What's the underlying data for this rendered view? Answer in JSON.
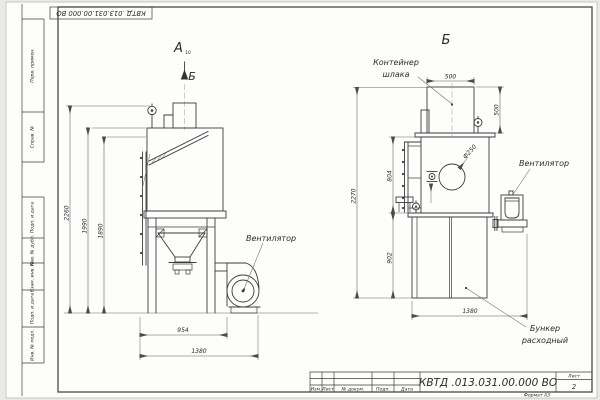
{
  "sheet": {
    "top_ref_code": "КВТД .013.031.00.000  ВО",
    "stamp_column": [
      "Перв. примен.",
      "Справ. №",
      "Подп. и дата",
      "Инв. № дубл.",
      "Взам. инв. №",
      "Подп. и дата",
      "Инв. № подл."
    ],
    "format_note": "Формат А3"
  },
  "title_block": {
    "code": "КВТД .013.031.00.000  ВО",
    "columns": [
      "Изм.",
      "Лист",
      "№ докум.",
      "Подп.",
      "Дата"
    ],
    "sheet_label": "Лист",
    "sheet_number": "2"
  },
  "views": {
    "a": {
      "label": "А",
      "label_sub": "10",
      "section_mark": "Б",
      "fan_label": "Вентилятор",
      "dims": {
        "h_total": "2260",
        "h_body": "1990",
        "h_inner": "1890",
        "w_frame": "954",
        "w_total": "1380"
      }
    },
    "b": {
      "label": "Б",
      "container_label_1": "Контейнер",
      "container_label_2": "шлака",
      "fan_label": "Вентилятор",
      "hopper_label_1": "Бункер",
      "hopper_label_2": "расходный",
      "dims": {
        "w_container": "500",
        "h_container": "500",
        "h_mid": "804",
        "h_total": "2270",
        "h_hopper": "902",
        "w_total": "1380",
        "d_port": "Ф250"
      }
    }
  },
  "colors": {
    "line": "#3c3c3c",
    "dim": "#5a5a5a",
    "background": "#e9e9e7",
    "sheet": "#fdfdfc"
  }
}
